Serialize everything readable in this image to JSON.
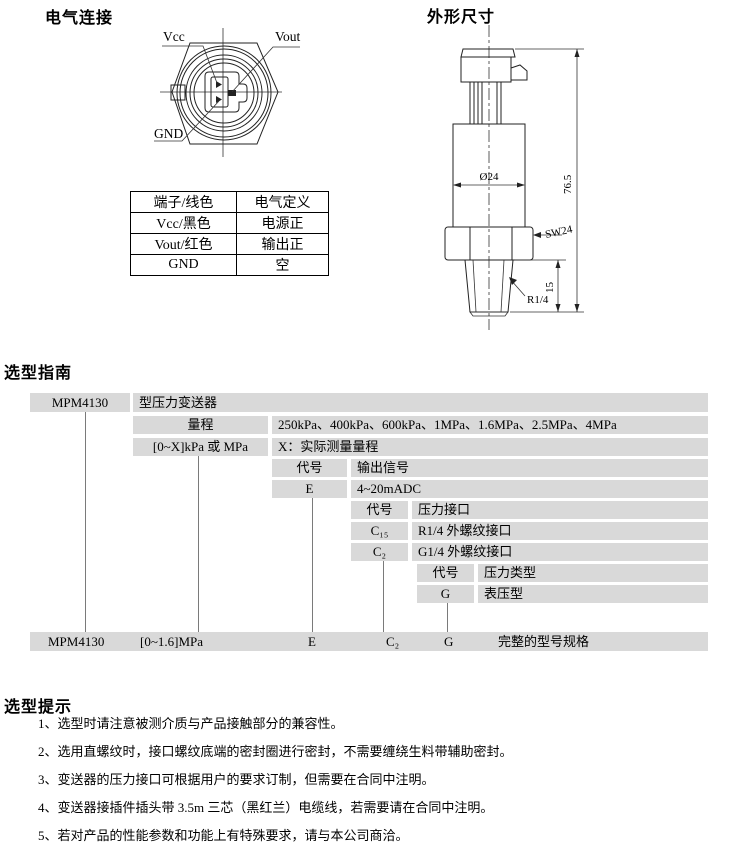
{
  "elec": {
    "title": "电气连接",
    "labels": {
      "vcc": "Vcc",
      "vout": "Vout",
      "gnd": "GND"
    },
    "table": {
      "col1": "端子/线色",
      "col2": "电气定义",
      "rows": [
        [
          "Vcc/黑色",
          "电源正"
        ],
        [
          "Vout/红色",
          "输出正"
        ],
        [
          "GND",
          "空"
        ]
      ]
    }
  },
  "outline": {
    "title": "外形尺寸",
    "dims": {
      "dia": "Ø24",
      "height": "76.5",
      "wrench": "SW24",
      "thread": "R1/4",
      "tlen": "15"
    }
  },
  "sel": {
    "title": "选型指南",
    "model": "MPM4130",
    "desc": "型压力变送器",
    "range_label": "量程",
    "ranges": "250kPa、400kPa、600kPa、1MPa、1.6MPa、2.5MPa、4MPa",
    "fmt": "[0~X]kPa 或 MPa",
    "fmt_note": "X：实际测量量程",
    "code": "代号",
    "out_hdr": "输出信号",
    "out_code": "E",
    "out_val": "4~20mADC",
    "port_hdr": "压力接口",
    "port_code1": "C₁₅",
    "port_val1": "R1/4 外螺纹接口",
    "port_code2": "C₂",
    "port_val2": "G1/4 外螺纹接口",
    "type_hdr": "压力类型",
    "type_code": "G",
    "type_val": "表压型",
    "ex_model": "MPM4130",
    "ex_range": "[0~1.6]MPa",
    "ex_out": "E",
    "ex_port": "C₂",
    "ex_type": "G",
    "ex_label": "完整的型号规格"
  },
  "tips": {
    "title": "选型提示",
    "items": [
      "1、选型时请注意被测介质与产品接触部分的兼容性。",
      "2、选用直螺纹时，接口螺纹底端的密封圈进行密封，不需要缠绕生料带辅助密封。",
      "3、变送器的压力接口可根据用户的要求订制，但需要在合同中注明。",
      "4、变送器接插件插头带 3.5m 三芯（黑红兰）电缆线，若需要请在合同中注明。",
      "5、若对产品的性能参数和功能上有特殊要求，请与本公司商洽。"
    ]
  },
  "colors": {
    "cell_bg": "#d9d9d9",
    "line": "#222222",
    "connector_line": "#7a7a7a"
  }
}
